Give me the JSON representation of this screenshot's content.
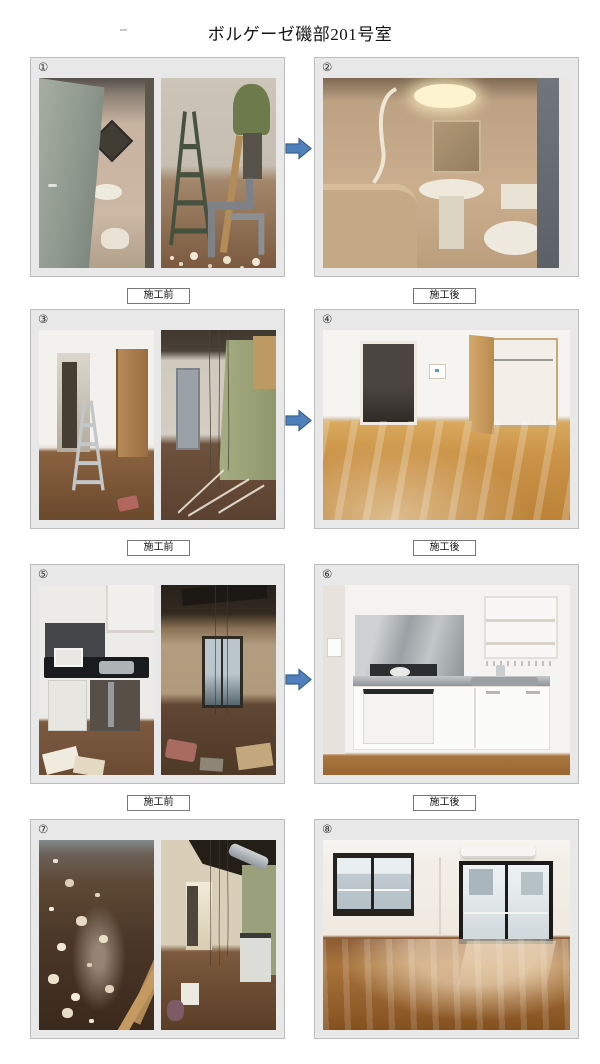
{
  "document": {
    "title": "ボルゲーゼ磯部201号室"
  },
  "arrow": {
    "direction": "right",
    "fill": "#4E80BC",
    "border": "#38618F"
  },
  "palette": {
    "page_background": "#FFFFFF",
    "panel_background": "#E8E8E8",
    "panel_border": "#BDBDBD",
    "caption_border": "#777777"
  },
  "rows": [
    {
      "before": {
        "number": "①",
        "caption": "施工前",
        "photos": [
          {
            "name": "bathroom-doorway-before",
            "description": "Open door revealing old unit bathroom with mirror, basin and toilet"
          },
          {
            "name": "plumbing-demolition",
            "description": "Worker in green jacket with stepladder, exposed pipes and debris"
          }
        ]
      },
      "after": {
        "number": "②",
        "caption": "施工後",
        "photo": {
          "name": "renovated-unit-bathroom",
          "description": "Refinished beige unit bathroom with bathtub, basin, mirror, ceiling light and toilet"
        }
      }
    },
    {
      "before": {
        "number": "③",
        "caption": "施工前",
        "photos": [
          {
            "name": "hallway-with-stepladder",
            "description": "Hallway with white walls, wooden closet door and aluminium stepladder on wood floor"
          },
          {
            "name": "wall-demolition",
            "description": "Stripped walls with green insulation board, exposed ceiling and hanging wires"
          }
        ]
      },
      "after": {
        "number": "④",
        "caption": "施工後",
        "photo": {
          "name": "renovated-western-room",
          "description": "Empty room with glossy wood flooring, open closet and hallway to entrance door"
        }
      }
    },
    {
      "before": {
        "number": "⑤",
        "caption": "施工前",
        "photos": [
          {
            "name": "old-kitchen-unit",
            "description": "Old kitchenette with black counter, stainless sink, mini fridge and debris on floor"
          },
          {
            "name": "gutted-room",
            "description": "Gutted room with dark ceiling, hanging wires and debris toward balcony window"
          }
        ]
      },
      "after": {
        "number": "⑥",
        "caption": "施工後",
        "photo": {
          "name": "renovated-compact-kitchen",
          "description": "White kitchenette with stainless splashback, gas burner, sink, shelves and fridge"
        }
      }
    },
    {
      "before": {
        "number": "⑦",
        "photos": [
          {
            "name": "debris-covered-floor",
            "description": "Dark wood floor strewn with plaster debris and leaning boards"
          },
          {
            "name": "corridor-demolition",
            "description": "Corridor with hanging wires, exposed duct, green wall and old kitchen unit"
          }
        ]
      },
      "after": {
        "number": "⑧",
        "photo": {
          "name": "renovated-living-room",
          "description": "Bright room with polished flooring, air conditioner, window and balcony sliding door"
        }
      }
    }
  ]
}
